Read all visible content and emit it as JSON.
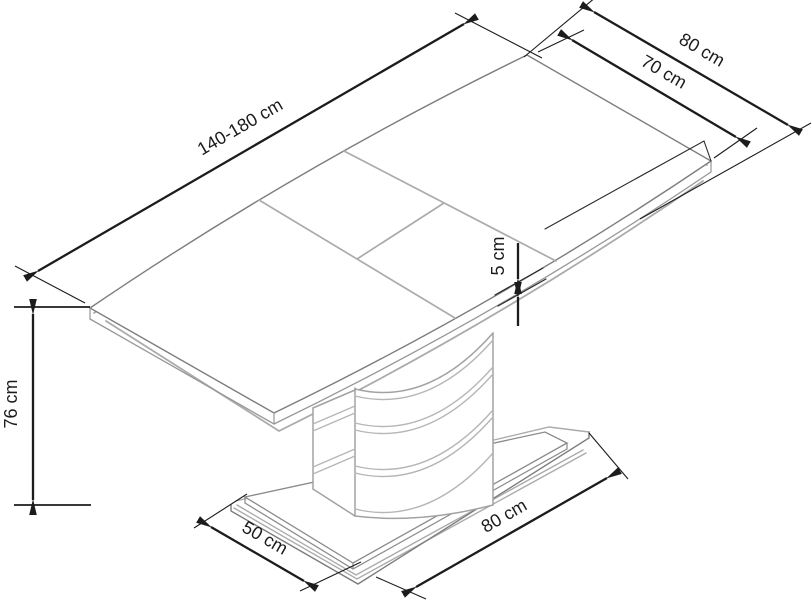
{
  "diagram": {
    "title": "Extendable pedestal dining table — dimension drawing",
    "labels": {
      "length": "140-180 cm",
      "end_width": "80 cm",
      "top_width": "70 cm",
      "top_thickness": "5 cm",
      "height": "76 cm",
      "base_depth": "50 cm",
      "base_length": "80 cm"
    },
    "colors": {
      "dimension": "#1c1c1c",
      "object_primary": "#7a7a7a",
      "object_secondary": "#a9a9a9",
      "background": "#ffffff"
    }
  }
}
